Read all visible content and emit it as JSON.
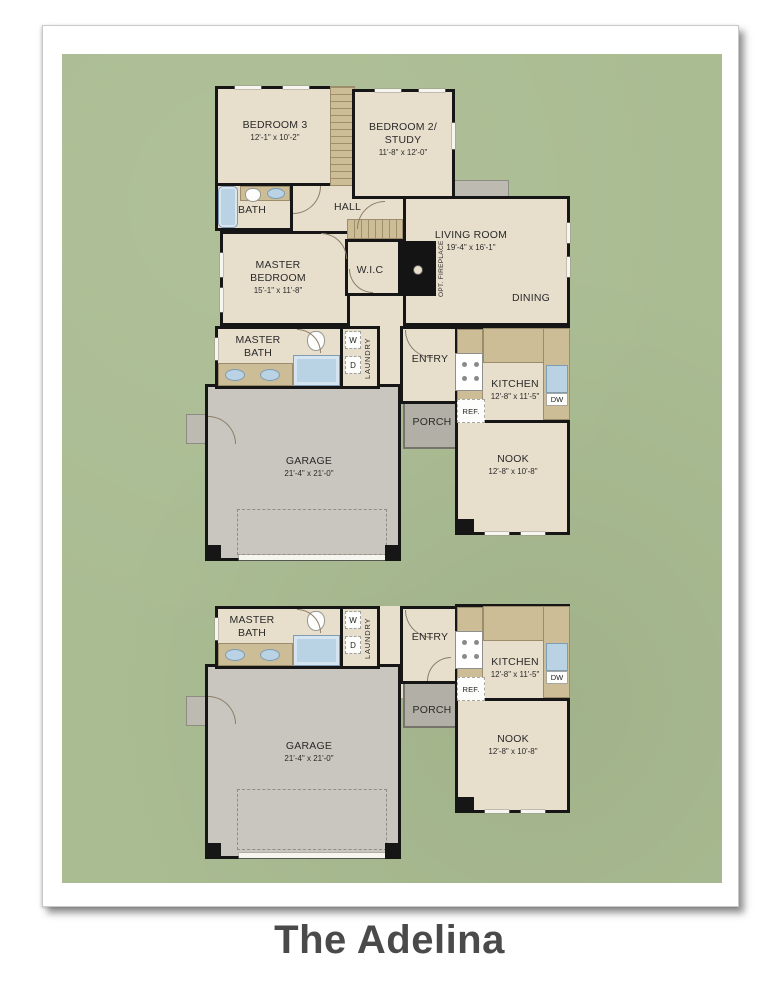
{
  "title": "The Adelina",
  "colors": {
    "background_green": "#aabc92",
    "floor_tan": "#e8decc",
    "counter_tan": "#cdbd97",
    "garage_gray": "#c9c6bf",
    "porch_gray": "#b2afa7",
    "wall": "#161616",
    "fixture_blue": "#b9d2e4",
    "title_text": "#4a4a4a"
  },
  "plan1": {
    "bedroom3": {
      "name": "BEDROOM 3",
      "dims": "12'-1\" x 10'-2\""
    },
    "bedroom2": {
      "name": "BEDROOM 2/",
      "name2": "STUDY",
      "dims": "11'-8\" x 12'-0\""
    },
    "bath": {
      "name": "BATH"
    },
    "hall": {
      "name": "HALL"
    },
    "master_bedroom": {
      "name": "MASTER",
      "name2": "BEDROOM",
      "dims": "15'-1\" x 11'-8\""
    },
    "wic": {
      "name": "W.I.C"
    },
    "living": {
      "name": "LIVING ROOM",
      "dims": "19'-4\" x 16'-1\""
    },
    "dining": {
      "name": "DINING"
    },
    "fireplace": {
      "name": "OPT. FIREPLACE"
    },
    "master_bath": {
      "name": "MASTER",
      "name2": "BATH"
    },
    "laundry": {
      "name": "LAUNDRY",
      "washer": "W",
      "dryer": "D"
    },
    "entry": {
      "name": "ENTRY"
    },
    "kitchen": {
      "name": "KITCHEN",
      "dims": "12'-8\" x 11'-5\"",
      "ref": "REF.",
      "dw": "DW"
    },
    "porch": {
      "name": "PORCH"
    },
    "garage": {
      "name": "GARAGE",
      "dims": "21'-4\" x 21'-0\""
    },
    "nook": {
      "name": "NOOK",
      "dims": "12'-8\" x 10'-8\""
    }
  },
  "plan2": {
    "master_bath": {
      "name": "MASTER",
      "name2": "BATH"
    },
    "laundry": {
      "name": "LAUNDRY",
      "washer": "W",
      "dryer": "D"
    },
    "entry": {
      "name": "ENTRY"
    },
    "kitchen": {
      "name": "KITCHEN",
      "dims": "12'-8\" x 11'-5\"",
      "ref": "REF.",
      "dw": "DW"
    },
    "porch": {
      "name": "PORCH"
    },
    "garage": {
      "name": "GARAGE",
      "dims": "21'-4\" x 21'-0\""
    },
    "nook": {
      "name": "NOOK",
      "dims": "12'-8\" x 10'-8\""
    }
  }
}
